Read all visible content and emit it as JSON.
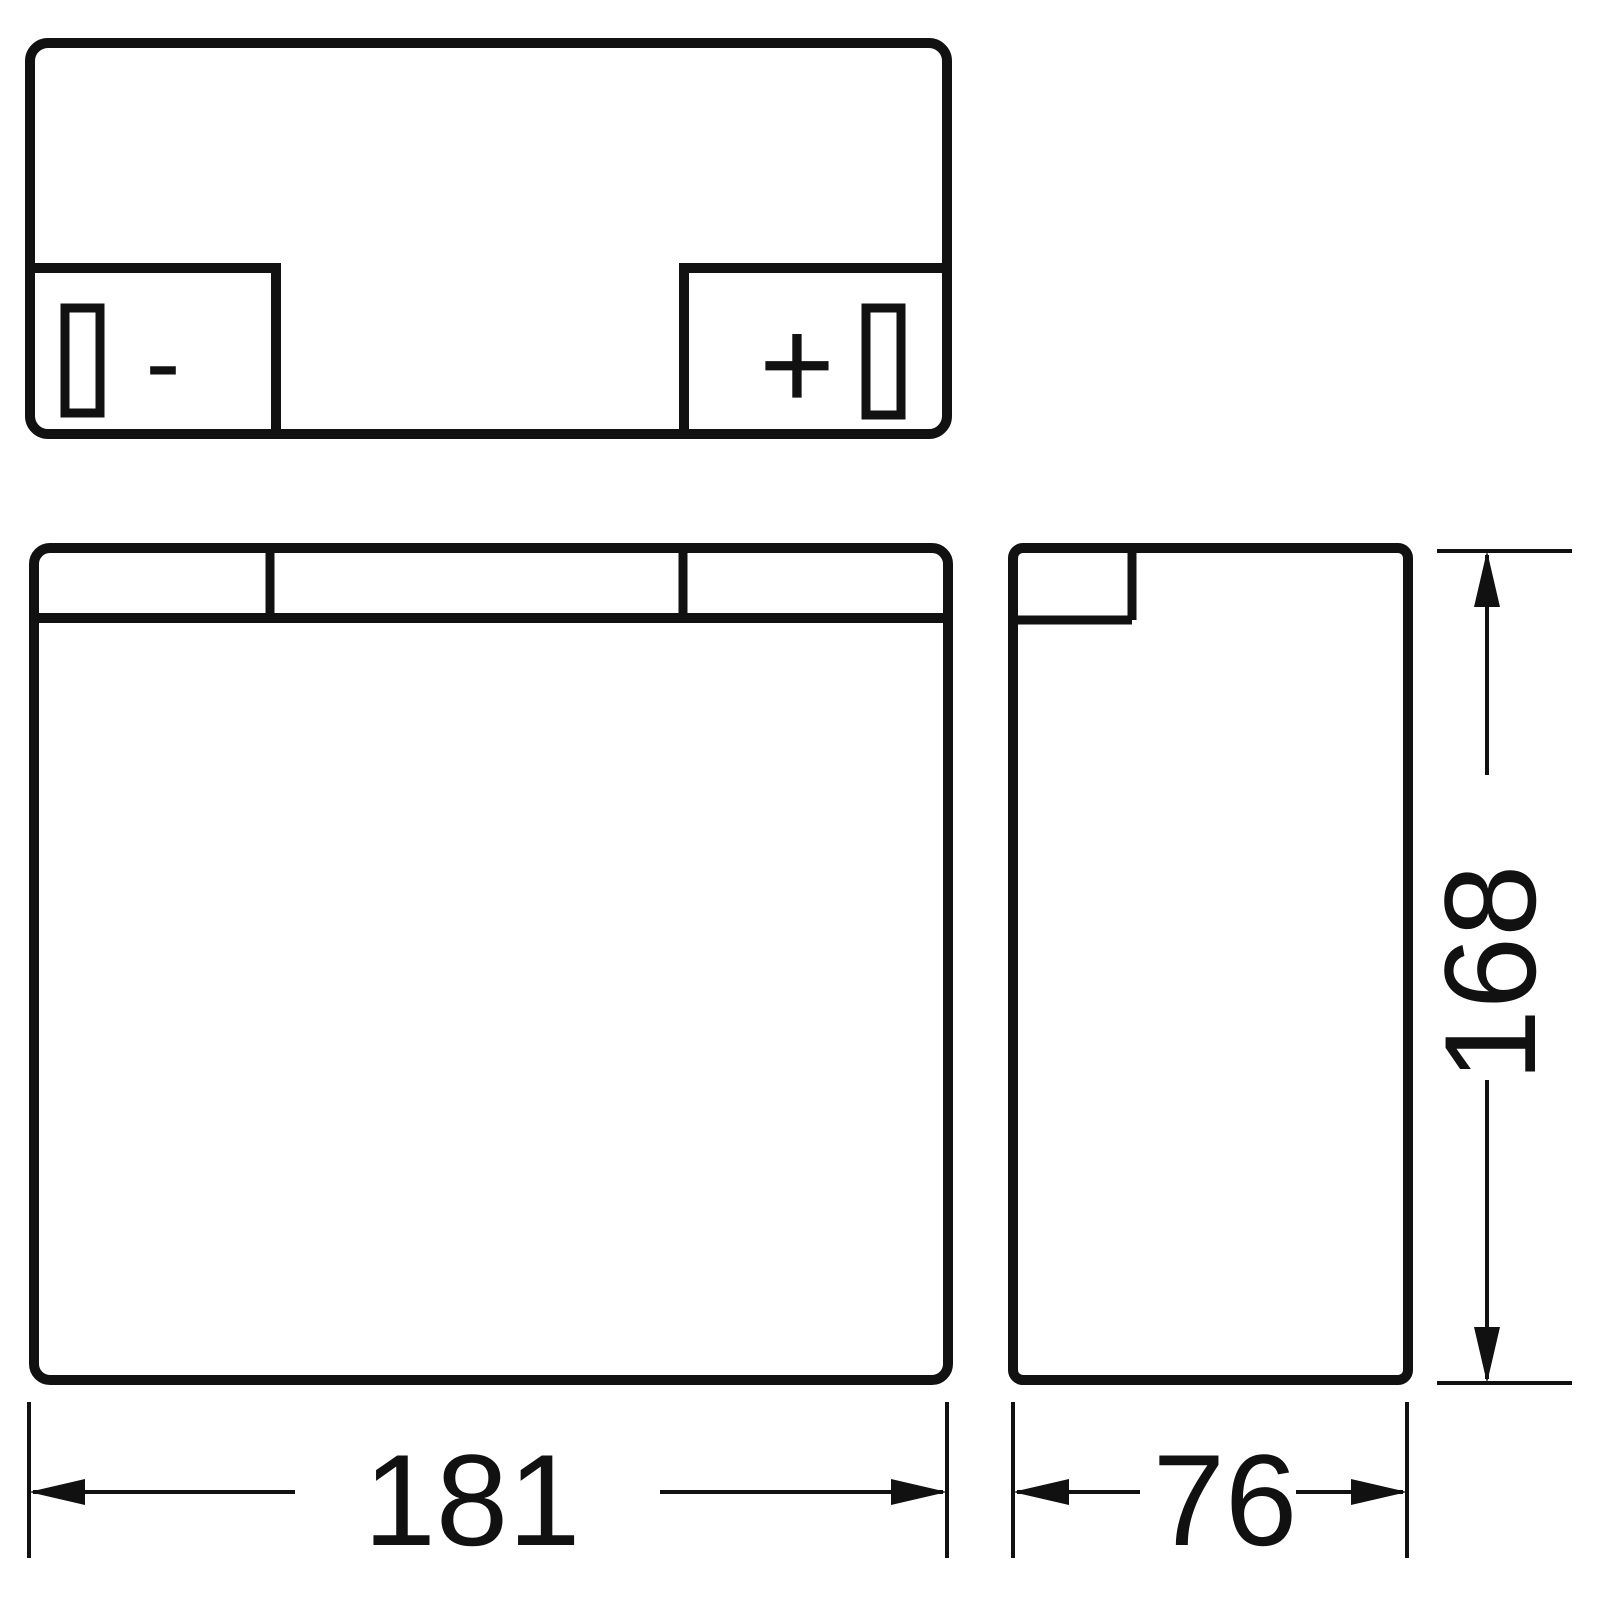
{
  "terminals": {
    "negative_symbol": "-",
    "positive_symbol": "+"
  },
  "dimensions": {
    "width_mm": "181",
    "depth_mm": "76",
    "height_mm": "168"
  },
  "colors": {
    "line": "#111111",
    "background": "#ffffff"
  }
}
